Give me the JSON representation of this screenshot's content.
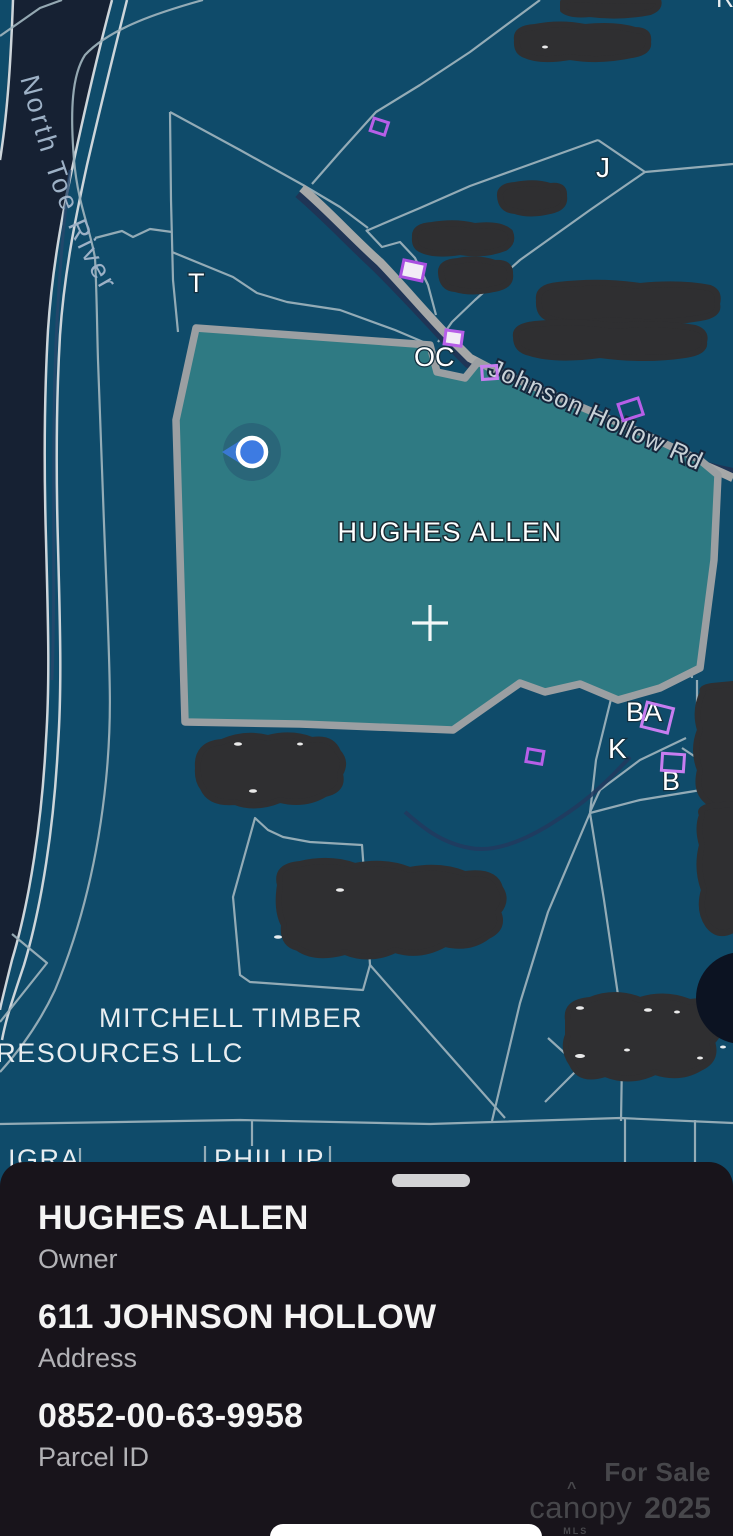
{
  "map": {
    "river_label": "North Toe River",
    "road_label": "Johnson Hollow Rd",
    "selected_label": "HUGHES ALLEN",
    "owner2_line1": "MITCHELL TIMBER",
    "owner2_line2": "RESOURCES LLC",
    "labels": {
      "t": "T",
      "j": "J",
      "oc": "OC",
      "ba": "BA",
      "k": "K",
      "b": "B"
    },
    "partial": {
      "top": "TAMB",
      "top2": "R",
      "bottom_left": "IGRA",
      "bottom_mid": "PHILLIP"
    }
  },
  "sheet": {
    "owner": {
      "value": "HUGHES ALLEN",
      "label": "Owner"
    },
    "address": {
      "value": "611 JOHNSON HOLLOW",
      "label": "Address"
    },
    "parcel": {
      "value": "0852-00-63-9958",
      "label": "Parcel ID"
    }
  },
  "watermark": {
    "for_sale": "For Sale",
    "brand": "canopy",
    "brand_sub": "MLS",
    "year": "2025",
    "roof": "^"
  },
  "colors": {
    "parcel_bg": "#0f4b6a",
    "selected_fill": "#2f7a83",
    "selected_border": "#9b9fa2",
    "boundary_line": "#9fb4bd",
    "river": "#162133",
    "road": "#a6a8a8",
    "stream": "#1f3556",
    "marker_purple": "#b75fe8",
    "location_blue": "#3d7be2",
    "redaction": "#2f2f31",
    "sheet_bg": "#18141b"
  }
}
